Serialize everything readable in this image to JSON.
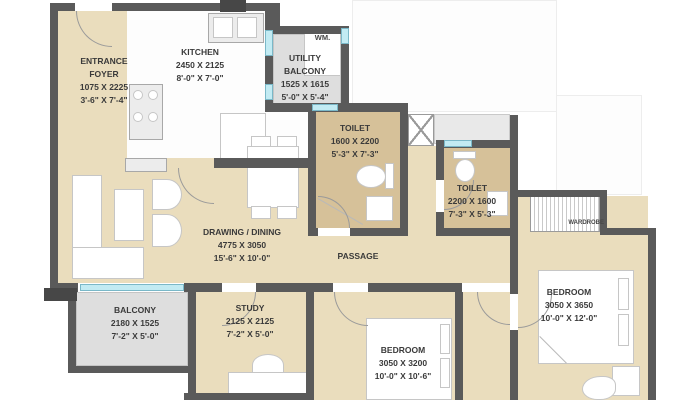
{
  "rooms": {
    "entrance_foyer": {
      "name": "ENTRANCE",
      "name2": "FOYER",
      "mm": "1075 X 2225",
      "ft": "3'-6\" X 7'-4\""
    },
    "kitchen": {
      "name": "KITCHEN",
      "mm": "2450 X 2125",
      "ft": "8'-0\" X 7'-0\""
    },
    "utility_balcony": {
      "name": "UTILITY",
      "name2": "BALCONY",
      "mm": "1525 X 1615",
      "ft": "5'-0\" X 5'-4\""
    },
    "toilet_1": {
      "name": "TOILET",
      "mm": "1600 X 2200",
      "ft": "5'-3\" X 7'-3\""
    },
    "toilet_2": {
      "name": "TOILET",
      "mm": "2200 X 1600",
      "ft": "7'-3\" X 5'-3\""
    },
    "drawing_dining": {
      "name": "DRAWING / DINING",
      "mm": "4775 X 3050",
      "ft": "15'-6\" X 10'-0\""
    },
    "passage": {
      "name": "PASSAGE"
    },
    "balcony": {
      "name": "BALCONY",
      "mm": "2180 X 1525",
      "ft": "7'-2\" X 5'-0\""
    },
    "study": {
      "name": "STUDY",
      "mm": "2125 X 2125",
      "ft": "7'-2\" X 5'-0\""
    },
    "bedroom_1": {
      "name": "BEDROOM",
      "mm": "3050 X 3200",
      "ft": "10'-0\" X 10'-6\""
    },
    "bedroom_2": {
      "name": "BEDROOM",
      "mm": "3050 X 3650",
      "ft": "10'-0\" X 12'-0\""
    }
  },
  "annotations": {
    "washing_machine": "WM.",
    "wardrobe": "WARDROBE"
  },
  "colors": {
    "floor": "#eaddbd",
    "toilet_floor": "#d6c199",
    "balcony_floor": "#dedede",
    "wall": "#5a5a5a",
    "window": "#c2ebf3"
  }
}
